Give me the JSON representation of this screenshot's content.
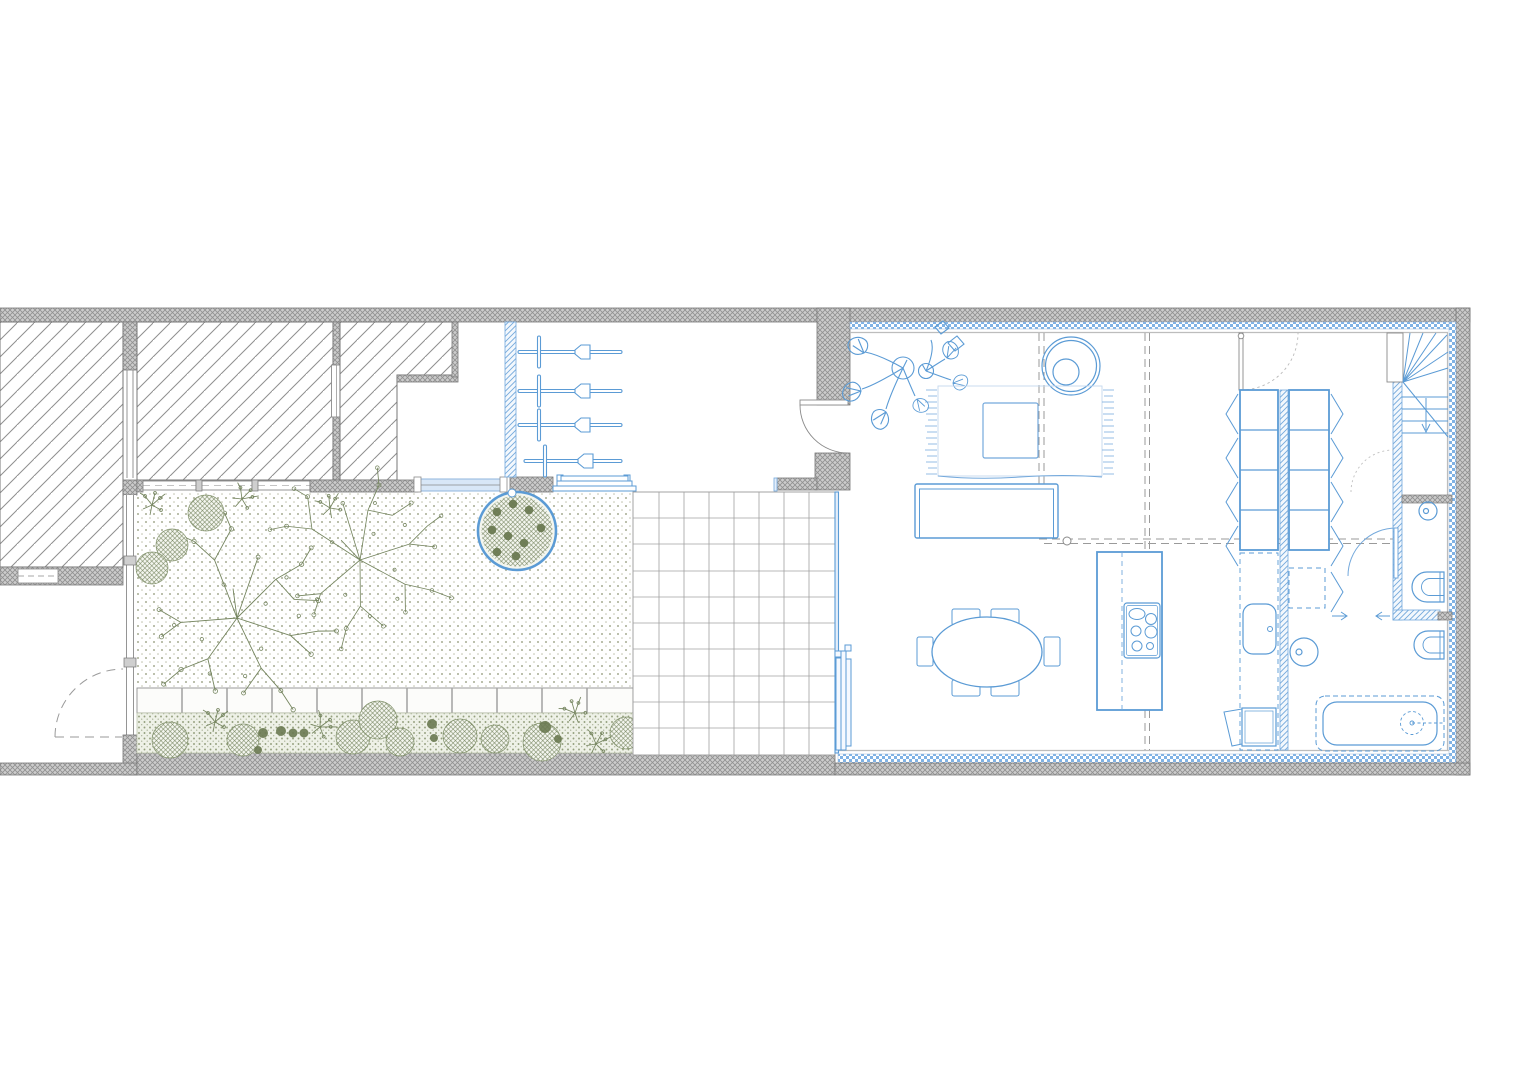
{
  "canvas": {
    "width": 1536,
    "height": 1086,
    "background": "#ffffff"
  },
  "colors": {
    "paper": "#ffffff",
    "wall-gray": "#cccccc",
    "wall-hatch-line": "#909090",
    "line-gray": "#8a8a8a",
    "dash-gray": "#9a9a9a",
    "neighbor-hatch-line": "#8f8f8f",
    "accent-blue": "#5b9bd5",
    "accent-blue-light": "#a8c8ea",
    "new-wall-blue": "#74a9dc",
    "insulation-blue": "#7fb2e5",
    "glazing-fill": "#e4eefa",
    "green-line": "#75855f",
    "green-solid": "#6b7a52",
    "garden-dot": "#8d9272",
    "bed-fill": "#eef1e7",
    "tile-line": "#a0a0a0"
  },
  "legend": {
    "gray-crosshatch": "existing masonry wall",
    "diagonal-hatch": "neighbouring structure",
    "blue-hatch": "new wall",
    "blue-checker": "insulation layer",
    "dotted-ground": "garden gravel",
    "square-grid": "patio tiles",
    "dashed-gray-line": "outline of floor above"
  },
  "elements": [
    "party-wall-top",
    "neighbor-block-west",
    "neighbor-block-mid",
    "neighbor-block-east",
    "garden-courtyard",
    "tree-circle-planter",
    "garden-trees",
    "shrub-bed",
    "paver-band",
    "patio-tile-grid",
    "garden-window-row",
    "new-blue-wall",
    "wall-plants-room",
    "entry-door",
    "porch-door-dashed",
    "living-room",
    "monstera-plant",
    "round-chair",
    "rug",
    "pouf",
    "sofa",
    "dining-table",
    "dining-chairs",
    "kitchen-island",
    "cooktop",
    "kitchen-counter",
    "kitchen-sink",
    "wardrobe-columns",
    "winder-stair",
    "stair-arrow",
    "wc-toilet",
    "wc-basin",
    "bathroom-basin",
    "bathroom-toilet",
    "bathtub",
    "sliding-glass-door",
    "void-dashed-lines"
  ]
}
